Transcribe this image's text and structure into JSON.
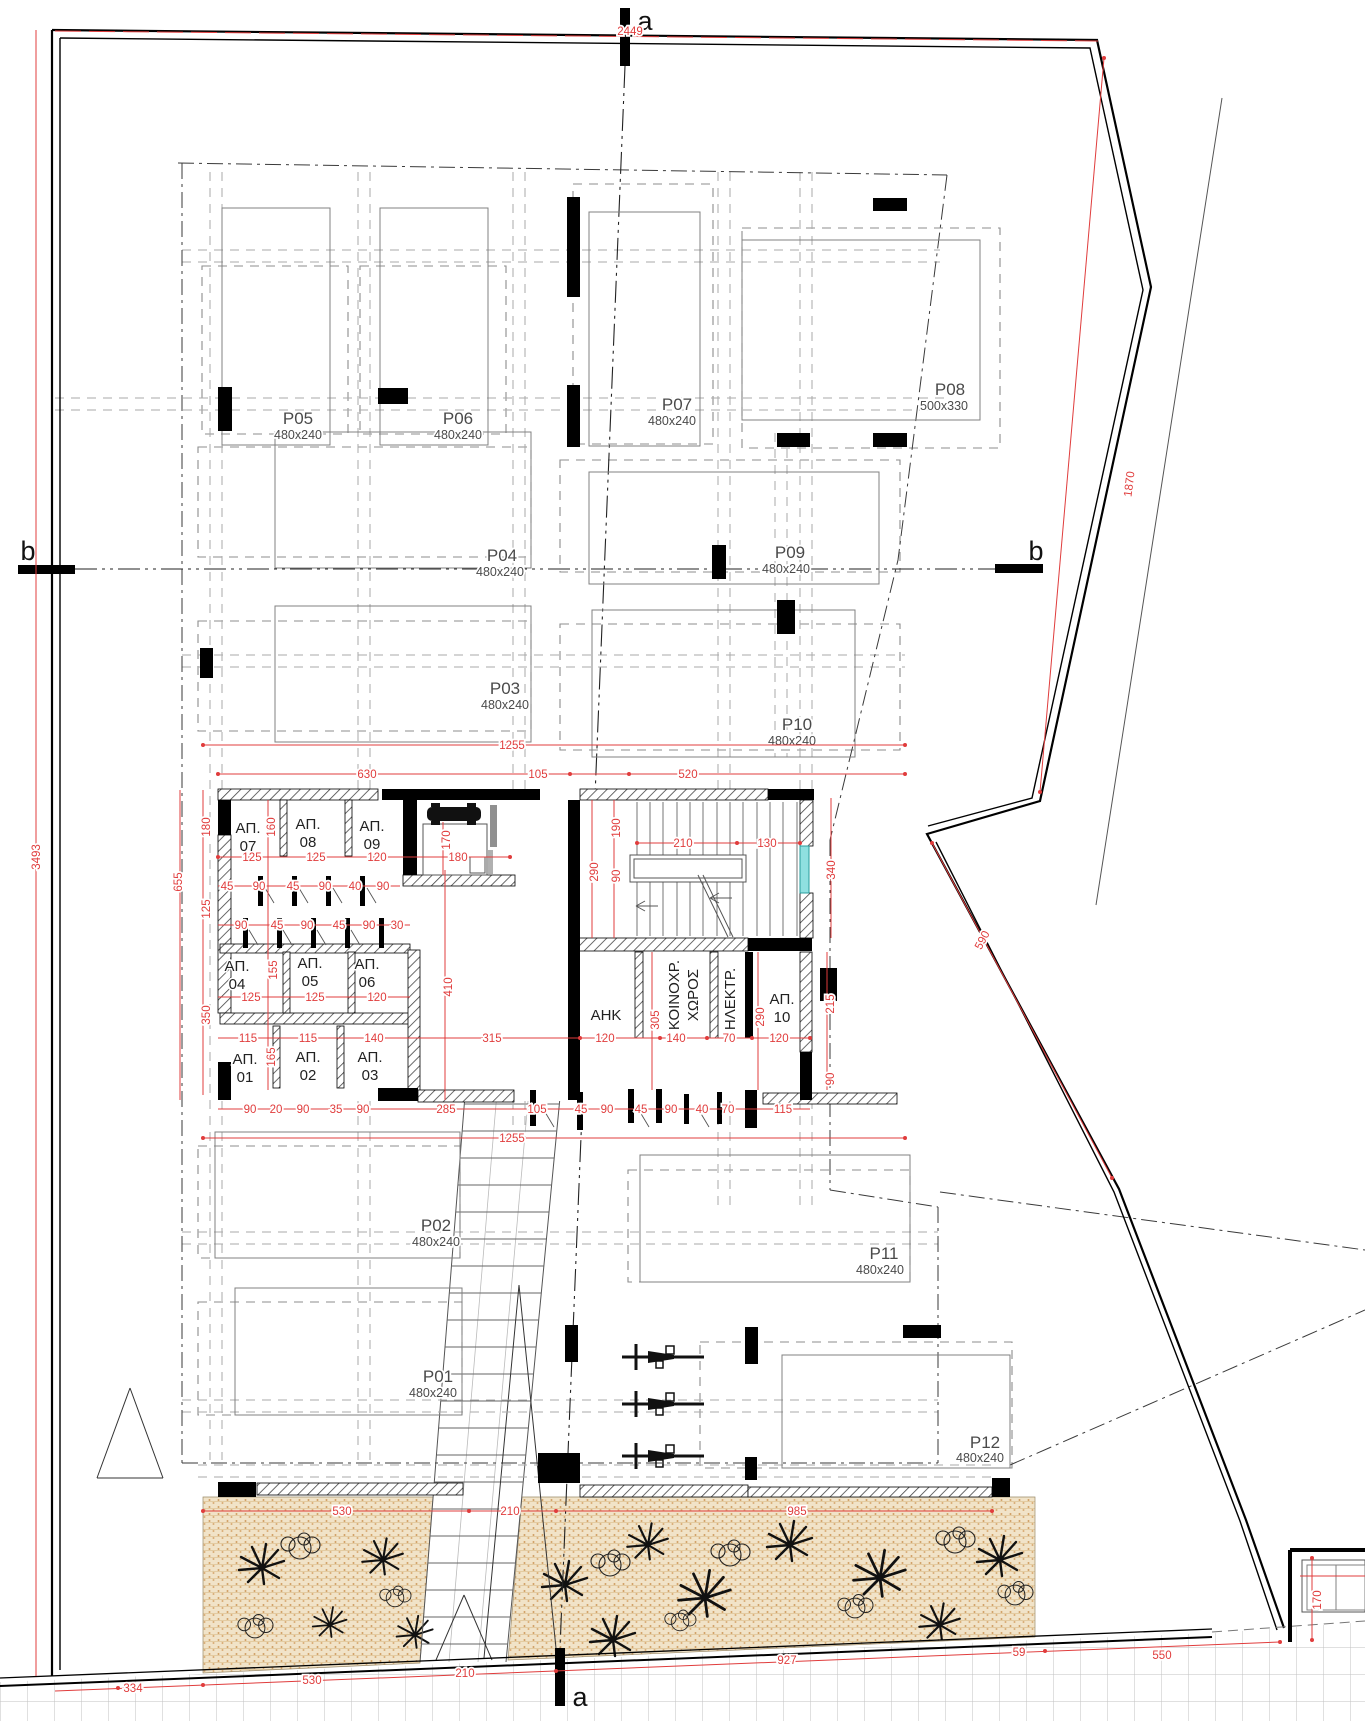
{
  "drawing_type": "architectural floor plan - ground floor parking level",
  "colors": {
    "dimension_red": "#e03c3c",
    "window_teal": "#8fe0e0",
    "planting_fill": "#f1e3c8",
    "planting_dot": "#cf9e63"
  },
  "sections": {
    "a": "a",
    "b": "b"
  },
  "parking": [
    {
      "id": "P01",
      "size": "480x240"
    },
    {
      "id": "P02",
      "size": "480x240"
    },
    {
      "id": "P03",
      "size": "480x240"
    },
    {
      "id": "P04",
      "size": "480x240"
    },
    {
      "id": "P05",
      "size": "480x240"
    },
    {
      "id": "P06",
      "size": "480x240"
    },
    {
      "id": "P07",
      "size": "480x240"
    },
    {
      "id": "P08",
      "size": "500x330"
    },
    {
      "id": "P09",
      "size": "480x240"
    },
    {
      "id": "P10",
      "size": "480x240"
    },
    {
      "id": "P11",
      "size": "480x240"
    },
    {
      "id": "P12",
      "size": "480x240"
    }
  ],
  "storage": [
    {
      "t": "ΑΠ.",
      "n": "01"
    },
    {
      "t": "ΑΠ.",
      "n": "02"
    },
    {
      "t": "ΑΠ.",
      "n": "03"
    },
    {
      "t": "ΑΠ.",
      "n": "04"
    },
    {
      "t": "ΑΠ.",
      "n": "05"
    },
    {
      "t": "ΑΠ.",
      "n": "06"
    },
    {
      "t": "ΑΠ.",
      "n": "07"
    },
    {
      "t": "ΑΠ.",
      "n": "08"
    },
    {
      "t": "ΑΠ.",
      "n": "09"
    },
    {
      "t": "ΑΠ.",
      "n": "10"
    }
  ],
  "rooms": {
    "ahk": "ΑΗΚ",
    "koin1": "ΚΟΙΝΟΧΡ.",
    "koin2": "ΧΩΡΟΣ",
    "ilektr": "ΗΛΕΚΤΡ."
  },
  "dims": {
    "site_top": "2449",
    "site_left": "3493",
    "site_right_upper": "1870",
    "site_right_lower": "590",
    "core_top_total": "1255",
    "core_top": [
      "630",
      "105",
      "520"
    ],
    "ap789_w": [
      "125",
      "125",
      "120",
      "180"
    ],
    "doors1": [
      "45",
      "90",
      "45",
      "90",
      "40",
      "90"
    ],
    "doors2": [
      "90",
      "45",
      "90",
      "45",
      "90",
      "30"
    ],
    "ap456_w": [
      "125",
      "125",
      "120"
    ],
    "ap123_w": [
      "115",
      "115",
      "140",
      "315"
    ],
    "bottom_row": [
      "90",
      "20",
      "90",
      "35",
      "90",
      "285",
      "105",
      "45",
      "90",
      "45",
      "90",
      "40",
      "70",
      "115"
    ],
    "core_bottom_total": "1255",
    "stair_w": [
      "210",
      "130"
    ],
    "stair_v": [
      "290",
      "190",
      "90",
      "340"
    ],
    "rooms_w": [
      "120",
      "140",
      "70",
      "120"
    ],
    "rooms_v": [
      "305",
      "290",
      "215",
      "90"
    ],
    "left_v": [
      "180",
      "160",
      "125",
      "350",
      "655",
      "155",
      "165"
    ],
    "lift_v": [
      "170",
      "410"
    ],
    "walls_bottom": [
      "530",
      "210",
      "985"
    ],
    "street": [
      "334",
      "530",
      "210",
      "927",
      "59",
      "550"
    ],
    "corner_v": "170"
  }
}
